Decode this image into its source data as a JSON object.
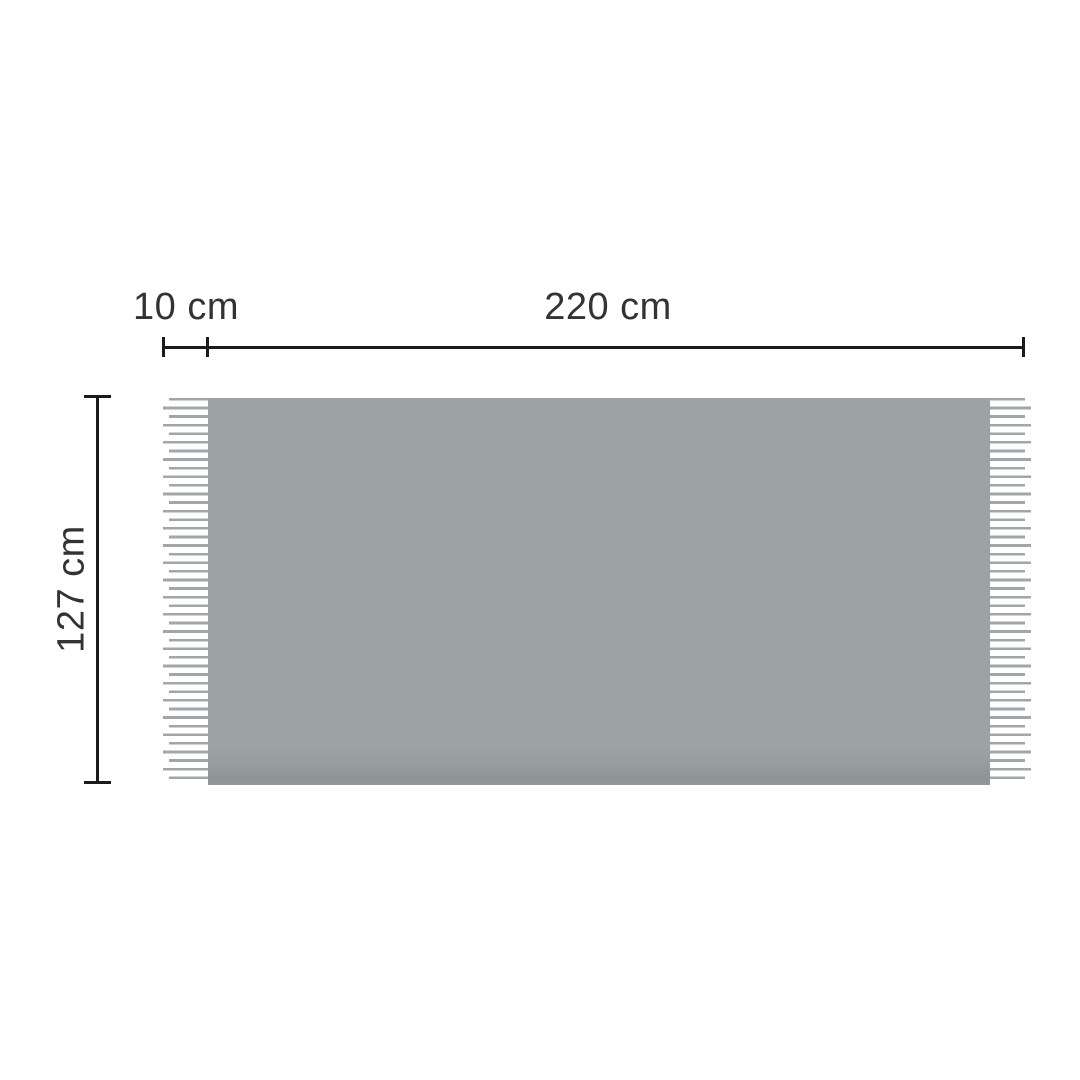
{
  "diagram": {
    "type": "product-dimension-diagram",
    "subject": "blanket-with-fringe",
    "labels": {
      "fringe_width": "10 cm",
      "blanket_width": "220 cm",
      "blanket_height": "127 cm"
    },
    "dimensions": {
      "fringe_width_cm": 10,
      "blanket_width_cm": 220,
      "blanket_height_cm": 127,
      "unit": "cm"
    },
    "colors": {
      "background": "#ffffff",
      "blanket_fill": "#9da2a5",
      "blanket_bottom_shade": "#8e9396",
      "fringe_line": "#a1a6a8",
      "dimension_line": "#1b1b1b",
      "label_text": "#333333"
    }
  }
}
